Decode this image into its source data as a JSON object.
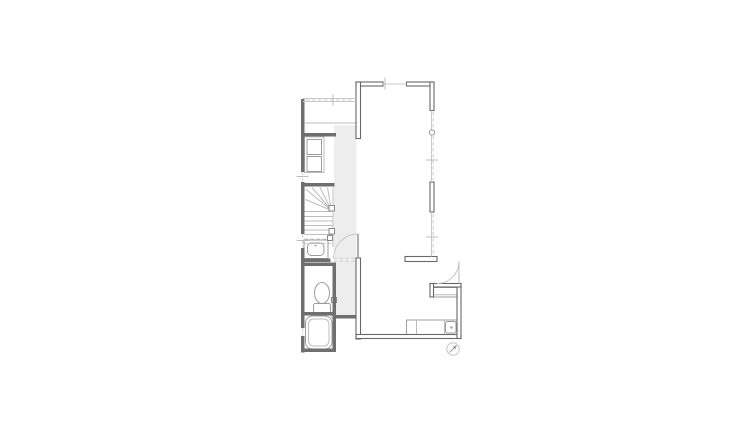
{
  "meta": {
    "type": "architectural-floor-plan",
    "canvas_width": 750,
    "canvas_height": 433
  },
  "palette": {
    "background": "#ffffff",
    "wall_fill": "#6f6f6f",
    "wall_outline": "#686868",
    "floor_shade": "#ededed",
    "fixture_line": "#9c9c9c",
    "light_line": "#c8c8c8"
  },
  "plan": {
    "layers": [
      {
        "name": "hall-floor-shading",
        "shapes": [
          {
            "t": "r",
            "x": 334,
            "y": 125.5,
            "w": 22.5,
            "h": 190,
            "c": "floor",
            "n": "hall-floor"
          }
        ]
      },
      {
        "name": "closet",
        "shapes": [
          {
            "t": "l",
            "x1": 305,
            "y1": 123,
            "x2": 356,
            "y2": 123,
            "c": "fixL",
            "n": "counter-line"
          },
          {
            "t": "r",
            "x": 304.5,
            "y": 137,
            "w": 19.5,
            "h": 35.5,
            "c": "fixL",
            "n": "closet-outline"
          },
          {
            "t": "r",
            "x": 307,
            "y": 139.5,
            "w": 14.5,
            "h": 15,
            "c": "fix",
            "n": "closet-shelf-upper"
          },
          {
            "t": "r",
            "x": 307,
            "y": 156.5,
            "w": 14.5,
            "h": 15,
            "c": "fix",
            "n": "closet-shelf-lower"
          }
        ]
      },
      {
        "name": "staircase",
        "shapes": [
          {
            "t": "l",
            "x1": 333,
            "y1": 187.5,
            "x2": 333,
            "y2": 247,
            "c": "fixL",
            "n": "stair-stringer"
          },
          {
            "t": "l",
            "x1": 331.5,
            "y1": 210.5,
            "x2": 305.5,
            "y2": 189,
            "c": "fixL",
            "n": "winder-line"
          },
          {
            "t": "l",
            "x1": 331.5,
            "y1": 210.5,
            "x2": 312,
            "y2": 187.5,
            "c": "fixL",
            "n": "winder-line"
          },
          {
            "t": "l",
            "x1": 331.5,
            "y1": 210.5,
            "x2": 320,
            "y2": 187.5,
            "c": "fixL",
            "n": "winder-line"
          },
          {
            "t": "l",
            "x1": 331.5,
            "y1": 210.5,
            "x2": 327.5,
            "y2": 187.5,
            "c": "fixL",
            "n": "winder-line"
          },
          {
            "t": "l",
            "x1": 331.5,
            "y1": 210.5,
            "x2": 305.5,
            "y2": 199.5,
            "c": "fixL",
            "n": "winder-line"
          },
          {
            "t": "l",
            "x1": 304.5,
            "y1": 211.5,
            "x2": 331.5,
            "y2": 211.5,
            "c": "fixL",
            "n": "tread"
          },
          {
            "t": "l",
            "x1": 304.5,
            "y1": 216.5,
            "x2": 333,
            "y2": 216.5,
            "c": "fixL",
            "n": "tread"
          },
          {
            "t": "l",
            "x1": 304.5,
            "y1": 221,
            "x2": 333,
            "y2": 221,
            "c": "fixL",
            "n": "tread"
          },
          {
            "t": "l",
            "x1": 304.5,
            "y1": 225.5,
            "x2": 333,
            "y2": 225.5,
            "c": "fixL",
            "n": "tread"
          },
          {
            "t": "l",
            "x1": 304.5,
            "y1": 230,
            "x2": 333,
            "y2": 230,
            "c": "fixL",
            "n": "tread"
          },
          {
            "t": "l",
            "x1": 304.5,
            "y1": 234.5,
            "x2": 333,
            "y2": 234.5,
            "c": "fixL",
            "n": "tread"
          },
          {
            "t": "l",
            "x1": 304.5,
            "y1": 239,
            "x2": 333,
            "y2": 239,
            "c": "dash",
            "n": "tread-hidden"
          },
          {
            "t": "l",
            "x1": 304.5,
            "y1": 243.5,
            "x2": 333,
            "y2": 243.5,
            "c": "dash",
            "n": "tread-hidden"
          },
          {
            "t": "r",
            "x": 329,
            "y": 205.5,
            "w": 5.5,
            "h": 5.5,
            "c": "sq",
            "n": "newel-post"
          },
          {
            "t": "r",
            "x": 329,
            "y": 228.5,
            "w": 5.5,
            "h": 5.5,
            "c": "sq",
            "n": "newel-post"
          }
        ]
      },
      {
        "name": "vanity",
        "shapes": [
          {
            "t": "r",
            "x": 304,
            "y": 240,
            "w": 24,
            "h": 18.5,
            "c": "fix",
            "n": "vanity-counter"
          },
          {
            "t": "r",
            "x": 307.5,
            "y": 243,
            "w": 16.5,
            "h": 12.5,
            "rx": 4,
            "c": "fix",
            "n": "vanity-basin"
          },
          {
            "t": "c",
            "cx": 315.5,
            "cy": 245.5,
            "r": 1,
            "c": "dot",
            "n": "vanity-faucet"
          },
          {
            "t": "r",
            "x": 327.5,
            "y": 235.5,
            "w": 5,
            "h": 5,
            "c": "sq",
            "n": "fixture-box"
          }
        ]
      },
      {
        "name": "toilet",
        "shapes": [
          {
            "t": "e",
            "cx": 322,
            "cy": 293,
            "rx": 7.5,
            "ry": 10.5,
            "c": "fix",
            "n": "toilet-bowl"
          },
          {
            "t": "r",
            "x": 313.5,
            "y": 303.5,
            "w": 17,
            "h": 9.5,
            "rx": 2,
            "c": "fixw",
            "n": "toilet-tank"
          },
          {
            "t": "r",
            "x": 331.5,
            "y": 297.5,
            "w": 5,
            "h": 5,
            "c": "sq",
            "n": "fixture-box"
          }
        ]
      },
      {
        "name": "bathtub",
        "shapes": [
          {
            "t": "r",
            "x": 305.5,
            "y": 316,
            "w": 26.5,
            "h": 33,
            "rx": 7,
            "c": "fix",
            "n": "tub-outer"
          },
          {
            "t": "r",
            "x": 308.5,
            "y": 319,
            "w": 20.5,
            "h": 27,
            "rx": 5,
            "c": "fixL",
            "n": "tub-inner"
          },
          {
            "t": "l",
            "x1": 329,
            "y1": 313.5,
            "x2": 334.5,
            "y2": 321,
            "c": "fixL",
            "n": "bath-door-mark"
          }
        ]
      },
      {
        "name": "kitchen",
        "shapes": [
          {
            "t": "r",
            "x": 406.5,
            "y": 320,
            "w": 50.5,
            "h": 14.5,
            "c": "fixw",
            "n": "kitchen-counter"
          },
          {
            "t": "l",
            "x1": 416.5,
            "y1": 320,
            "x2": 416.5,
            "y2": 334.5,
            "c": "fixL",
            "n": "counter-divider"
          },
          {
            "t": "l",
            "x1": 444.5,
            "y1": 320,
            "x2": 444.5,
            "y2": 334.5,
            "c": "fixL",
            "n": "counter-divider"
          },
          {
            "t": "r",
            "x": 445.5,
            "y": 321.5,
            "w": 10.5,
            "h": 11.5,
            "rx": 2,
            "c": "fix",
            "n": "kitchen-sink"
          },
          {
            "t": "c",
            "cx": 451.5,
            "cy": 327.5,
            "r": 1.2,
            "c": "dot",
            "n": "sink-drain"
          }
        ]
      },
      {
        "name": "shoe-cabinet",
        "shapes": [
          {
            "t": "r",
            "x": 431.5,
            "y": 287.5,
            "w": 26,
            "h": 9.5,
            "c": "fixw",
            "n": "shoe-cabinet-outline"
          },
          {
            "t": "l",
            "x1": 431.5,
            "y1": 294.8,
            "x2": 457.5,
            "y2": 294.8,
            "c": "fixL",
            "n": "shoe-cabinet-line"
          }
        ]
      },
      {
        "name": "interior-walls",
        "shapes": [
          {
            "t": "r",
            "x": 301,
            "y": 99,
            "w": 3.5,
            "h": 36.5,
            "c": "wallA",
            "n": "left-wall"
          },
          {
            "t": "r",
            "x": 301,
            "y": 133,
            "w": 3.5,
            "h": 39,
            "c": "wallA",
            "n": "left-wall"
          },
          {
            "t": "r",
            "x": 301,
            "y": 182,
            "w": 3.5,
            "h": 52,
            "c": "wallA",
            "n": "left-wall"
          },
          {
            "t": "r",
            "x": 301,
            "y": 248,
            "w": 3.5,
            "h": 80,
            "c": "wallA",
            "n": "left-wall"
          },
          {
            "t": "r",
            "x": 301,
            "y": 336,
            "w": 3.5,
            "h": 16.5,
            "c": "wallA",
            "n": "left-wall"
          },
          {
            "t": "r",
            "x": 301,
            "y": 133,
            "w": 35,
            "h": 3.5,
            "c": "wallA",
            "n": "room-south-wall"
          },
          {
            "t": "r",
            "x": 303,
            "y": 183,
            "w": 31.5,
            "h": 3.5,
            "c": "wallA",
            "n": "stair-north-wall"
          },
          {
            "t": "r",
            "x": 303,
            "y": 258.5,
            "w": 27.5,
            "h": 3.5,
            "c": "wallA",
            "n": "vanity-south-wall"
          },
          {
            "t": "r",
            "x": 303,
            "y": 262.5,
            "w": 32.5,
            "h": 3.5,
            "c": "wallA",
            "n": "toilet-north-wall"
          },
          {
            "t": "r",
            "x": 332.5,
            "y": 262.5,
            "w": 3.5,
            "h": 53,
            "c": "wallA",
            "n": "toilet-east-wall"
          },
          {
            "t": "r",
            "x": 303,
            "y": 312,
            "w": 33,
            "h": 3.5,
            "c": "wallA",
            "n": "bath-north-wall"
          },
          {
            "t": "r",
            "x": 332.5,
            "y": 312,
            "w": 3.5,
            "h": 40,
            "c": "wallA",
            "n": "bath-east-wall"
          },
          {
            "t": "r",
            "x": 301,
            "y": 348.5,
            "w": 35,
            "h": 3.5,
            "c": "wallA",
            "n": "bath-south-wall"
          },
          {
            "t": "r",
            "x": 333.5,
            "y": 315,
            "w": 25,
            "h": 3.5,
            "c": "wallA",
            "n": "hall-south-wall"
          }
        ]
      },
      {
        "name": "exterior-walls",
        "shapes": [
          {
            "t": "r",
            "x": 356,
            "y": 82,
            "w": 27,
            "h": 4,
            "c": "wallB",
            "n": "north-wall-west"
          },
          {
            "t": "r",
            "x": 406.5,
            "y": 82,
            "w": 27.5,
            "h": 4,
            "c": "wallB",
            "n": "north-wall-east"
          },
          {
            "t": "r",
            "x": 430,
            "y": 82,
            "w": 4,
            "h": 28.5,
            "c": "wallB",
            "n": "east-wall-upper"
          },
          {
            "t": "r",
            "x": 430,
            "y": 182,
            "w": 4,
            "h": 30,
            "c": "wallB",
            "n": "east-wall-mid"
          },
          {
            "t": "r",
            "x": 356,
            "y": 82,
            "w": 4.5,
            "h": 56.5,
            "c": "wallB",
            "n": "west-wall-upper"
          },
          {
            "t": "r",
            "x": 356,
            "y": 258,
            "w": 4.5,
            "h": 81,
            "c": "wallB",
            "n": "west-wall-lower"
          },
          {
            "t": "r",
            "x": 356,
            "y": 334.5,
            "w": 105,
            "h": 4,
            "c": "wallB",
            "n": "south-wall"
          },
          {
            "t": "r",
            "x": 457,
            "y": 283.5,
            "w": 4,
            "h": 55,
            "c": "wallB",
            "n": "vestibule-east-wall"
          },
          {
            "t": "r",
            "x": 430,
            "y": 283.5,
            "w": 31,
            "h": 3.5,
            "c": "wallB",
            "n": "vestibule-north-wall"
          },
          {
            "t": "r",
            "x": 430,
            "y": 283.5,
            "w": 3.5,
            "h": 13.5,
            "c": "wallB",
            "n": "vestibule-stub-wall"
          },
          {
            "t": "r",
            "x": 405,
            "y": 256.5,
            "w": 32,
            "h": 5,
            "c": "wallB",
            "n": "entry-partial-wall"
          }
        ]
      },
      {
        "name": "windows",
        "shapes": [
          {
            "t": "l",
            "x1": 382.5,
            "y1": 84,
            "x2": 406.5,
            "y2": 84,
            "c": "win",
            "n": "window-north"
          },
          {
            "t": "l",
            "x1": 431.5,
            "y1": 110.5,
            "x2": 431.5,
            "y2": 182,
            "c": "win",
            "n": "window-east-upper"
          },
          {
            "t": "l",
            "x1": 433.2,
            "y1": 112,
            "x2": 433.2,
            "y2": 180,
            "c": "dash",
            "n": "window-east-upper-dash"
          },
          {
            "t": "l",
            "x1": 431.5,
            "y1": 212,
            "x2": 431.5,
            "y2": 256.5,
            "c": "win",
            "n": "window-east-lower"
          },
          {
            "t": "l",
            "x1": 433.2,
            "y1": 214,
            "x2": 433.2,
            "y2": 255,
            "c": "dash",
            "n": "window-east-lower-dash"
          },
          {
            "t": "l",
            "x1": 303,
            "y1": 98.5,
            "x2": 356,
            "y2": 98.5,
            "c": "win",
            "n": "window-room-north"
          },
          {
            "t": "l",
            "x1": 303,
            "y1": 101.5,
            "x2": 356,
            "y2": 101.5,
            "c": "win",
            "n": "window-room-north"
          },
          {
            "t": "l",
            "x1": 306,
            "y1": 100,
            "x2": 354,
            "y2": 100,
            "c": "dash",
            "n": "window-room-north-dash"
          },
          {
            "t": "l",
            "x1": 302.7,
            "y1": 172,
            "x2": 302.7,
            "y2": 181.5,
            "c": "dash",
            "n": "window-west"
          },
          {
            "t": "l",
            "x1": 302.7,
            "y1": 234,
            "x2": 302.7,
            "y2": 247.5,
            "c": "dash",
            "n": "window-west"
          },
          {
            "t": "l",
            "x1": 302.7,
            "y1": 328,
            "x2": 302.7,
            "y2": 335.5,
            "c": "dash",
            "n": "window-west"
          },
          {
            "t": "c",
            "cx": 432,
            "cy": 132.5,
            "r": 2.6,
            "c": "fixw",
            "n": "vent-symbol"
          }
        ]
      },
      {
        "name": "grid-ticks",
        "shapes": [
          {
            "t": "l",
            "x1": 385,
            "y1": 77.5,
            "x2": 385,
            "y2": 89.5,
            "c": "tick",
            "n": "tick-mark"
          },
          {
            "t": "l",
            "x1": 333,
            "y1": 94.5,
            "x2": 333,
            "y2": 105.5,
            "c": "tick",
            "n": "tick-mark"
          },
          {
            "t": "l",
            "x1": 426,
            "y1": 160,
            "x2": 438,
            "y2": 160,
            "c": "tick",
            "n": "tick-mark"
          },
          {
            "t": "l",
            "x1": 426,
            "y1": 237,
            "x2": 438,
            "y2": 237,
            "c": "tick",
            "n": "tick-mark"
          },
          {
            "t": "l",
            "x1": 296.5,
            "y1": 176.5,
            "x2": 308.5,
            "y2": 176.5,
            "c": "tick",
            "n": "tick-mark"
          },
          {
            "t": "l",
            "x1": 296.5,
            "y1": 240.5,
            "x2": 308.5,
            "y2": 240.5,
            "c": "tick",
            "n": "tick-mark"
          }
        ]
      },
      {
        "name": "hall-door",
        "shapes": [
          {
            "t": "p",
            "d": "M 333.5 258.5 A 24.5 24.5 0 0 1 358 234",
            "c": "arc",
            "n": "door-swing-arc"
          },
          {
            "t": "l",
            "x1": 358,
            "y1": 234,
            "x2": 358,
            "y2": 258.5,
            "c": "leaf",
            "n": "door-leaf"
          },
          {
            "t": "l",
            "x1": 333.5,
            "y1": 258.3,
            "x2": 355.5,
            "y2": 258.3,
            "c": "dash",
            "n": "door-opening"
          },
          {
            "t": "l",
            "x1": 333.5,
            "y1": 261.3,
            "x2": 355.5,
            "y2": 261.3,
            "c": "dash",
            "n": "door-opening"
          }
        ]
      },
      {
        "name": "entry-door",
        "shapes": [
          {
            "t": "p",
            "d": "M 459 261.5 A 22 22 0 0 1 437 283.5",
            "c": "arc",
            "n": "entry-swing-arc"
          },
          {
            "t": "l",
            "x1": 459,
            "y1": 261.5,
            "x2": 459,
            "y2": 283.5,
            "c": "fixL",
            "n": "entry-door-leaf"
          }
        ]
      },
      {
        "name": "north-arrow",
        "shapes": [
          {
            "t": "c",
            "cx": 453,
            "cy": 349,
            "r": 6.2,
            "c": "sym",
            "n": "north-arrow-circle"
          },
          {
            "t": "l",
            "x1": 449.5,
            "y1": 352.5,
            "x2": 455.5,
            "y2": 346.5,
            "c": "fix",
            "n": "north-arrow-line"
          },
          {
            "t": "g",
            "pts": "457,345 452.8,346.6 455.4,349.4",
            "c": "ah",
            "n": "north-arrow-head"
          }
        ]
      }
    ]
  }
}
